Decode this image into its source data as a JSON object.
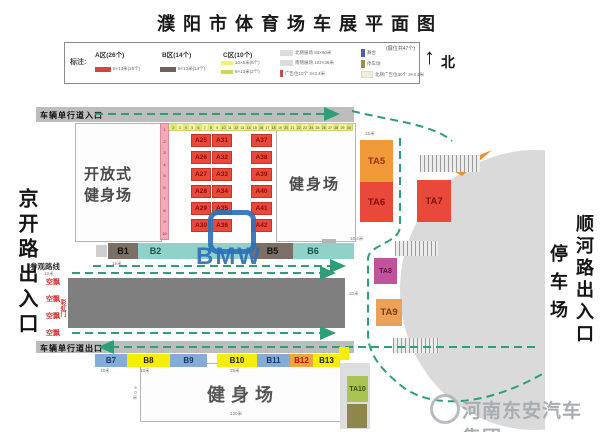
{
  "title": "濮阳市体育场车展平面图",
  "north_label": "北",
  "legend": {
    "heading": "标注:",
    "total_note": "(展位共47个)",
    "zone_a": {
      "name": "A区(26个)",
      "desc": "8×13米(26个)",
      "color": "#cf4a38"
    },
    "zone_b": {
      "name": "B区(14个)",
      "desc": "8×13米(14个)",
      "color": "#6e625c"
    },
    "zone_c": {
      "name": "C区(10个)",
      "desc1": "10×5米(8个)",
      "desc2": "8×13米(2个)",
      "color1": "#f2ef7a",
      "color2": "#cbd94e"
    },
    "item_north_field": "北侧展场 83×60米",
    "item_south_field": "南侧展场 102×35米",
    "item_ad": "广告位10个 3×3.4米",
    "item_stage": "舞台",
    "item_parking": "停车场",
    "item_north_ad": "北侧广告位30个 3×3.4米"
  },
  "roads": {
    "top_entry": "车辆单行道入口",
    "bottom_exit": "车辆单行道出口",
    "visit_route": "参观路线"
  },
  "gates": {
    "left": "京开路出入口",
    "right": "顺河路出入口",
    "parking": "停车场"
  },
  "areas": {
    "open_fitness": "开放式健身场",
    "fitness_right": "健身场",
    "fitness_bottom": "健身场"
  },
  "decor": {
    "balloon": "空飘",
    "rainbow_gate": "彩虹门"
  },
  "booths": {
    "a_col1": [
      "A25",
      "A26",
      "A27",
      "A28",
      "A29",
      "A30"
    ],
    "a_col2": [
      "A31",
      "A32",
      "A33",
      "A34",
      "A35",
      "A36"
    ],
    "a_col3": [
      "A37",
      "A38",
      "A39",
      "A40",
      "A41",
      "A42"
    ],
    "b_top": [
      {
        "label": "B1",
        "style": "dark"
      },
      {
        "label": "B2",
        "style": "teal"
      },
      {
        "label": "B5",
        "style": "dark"
      },
      {
        "label": "B6",
        "style": "teal"
      }
    ],
    "b_bottom": [
      {
        "label": "B7",
        "style": "blue"
      },
      {
        "label": "B8",
        "style": "yellow"
      },
      {
        "label": "B9",
        "style": "blue"
      },
      {
        "label": "B10",
        "style": "yellow"
      },
      {
        "label": "B11",
        "style": "blue"
      },
      {
        "label": "B12",
        "style": "orange"
      },
      {
        "label": "B13",
        "style": "yellow"
      }
    ],
    "ta": [
      {
        "label": "TA5",
        "color": "#f09a3a",
        "text": "#a03008"
      },
      {
        "label": "TA6",
        "color": "#e8493a",
        "text": "#7d1109"
      },
      {
        "label": "TA7",
        "color": "#e8493a",
        "text": "#7d1109"
      },
      {
        "label": "TA8",
        "color": "#c0549c",
        "text": "#58103f"
      },
      {
        "label": "TA9",
        "color": "#eca158",
        "text": "#7a3c0c"
      },
      {
        "label": "TA10",
        "color": "#a9c455",
        "text": "#3c4d12"
      }
    ]
  },
  "strips": {
    "top_numbers_from": 1,
    "top_numbers_to": 30,
    "left_numbers_from": 1,
    "left_numbers_to": 10
  },
  "dims": {
    "b1": "15米",
    "route": "12米",
    "b7": "18米",
    "b8": "18米",
    "b10": "35米",
    "field_bottom": "120米",
    "field_height": "40米",
    "ta5": "15米",
    "b6": "15.4米",
    "ta9": "10米"
  },
  "watermarks": {
    "bmw": "BMW",
    "company": "河南东安汽车集团"
  },
  "colors": {
    "route_green": "#2f9e77",
    "booth_red": "#e8493a",
    "stage_gray": "#7f7f7f",
    "bowl_gray": "#dadada"
  }
}
